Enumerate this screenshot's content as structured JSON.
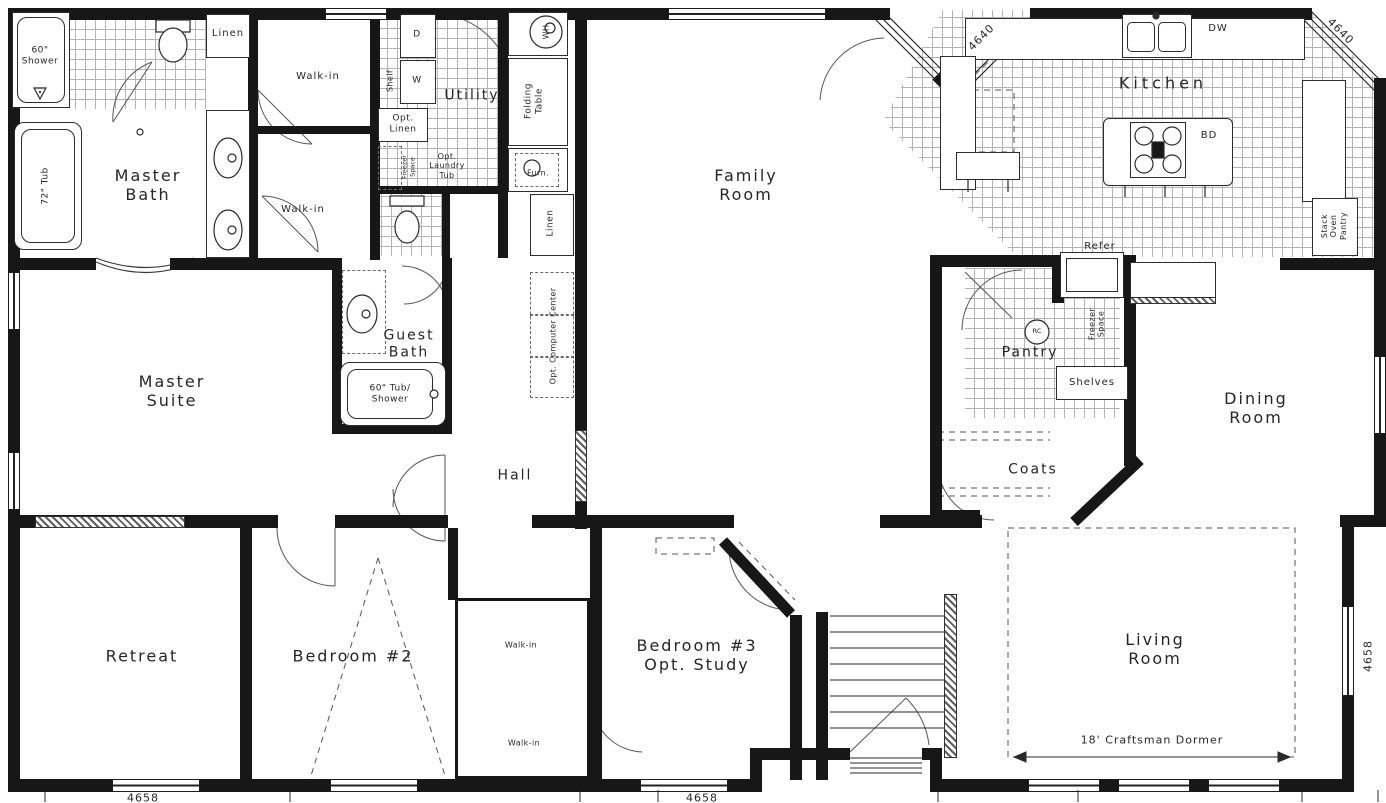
{
  "rooms": {
    "master_bath": "Master\nBath",
    "master_suite": "Master\nSuite",
    "guest_bath": "Guest\nBath",
    "utility": "Utility",
    "hall": "Hall",
    "family_room": "Family\nRoom",
    "kitchen": "Kitchen",
    "pantry": "Pantry",
    "dining_room": "Dining\nRoom",
    "coats": "Coats",
    "retreat": "Retreat",
    "bedroom_2": "Bedroom #2",
    "bedroom_3": "Bedroom #3\nOpt. Study",
    "living_room": "Living\nRoom"
  },
  "closets": {
    "linen_top": "Linen",
    "walkin_master_1": "Walk-in",
    "walkin_master_2": "Walk-in",
    "linen_hall": "Linen",
    "opt_linen": "Opt.\nLinen",
    "shelf": "Shelf",
    "folding_table": "Folding\nTable",
    "walkin_bed3_1": "Walk-in",
    "walkin_bed3_2": "Walk-in",
    "shelves": "Shelves",
    "stack_oven_pantry": "Stack\nOven\nPantry",
    "opt_computer_center": "Opt. Computer Center",
    "freezer_space_pantry": "Freezer\nSpace",
    "freezer_space_utility": "Freezer\nSpace"
  },
  "fixtures": {
    "shower_60": "60\"\nShower",
    "tub_72": "72\" Tub",
    "tub_shower_60": "60\" Tub/\nShower",
    "opt_laundry_tub": "Opt.\nLaundry\nTub",
    "dryer": "D",
    "washer": "W",
    "water_heater": "WH",
    "furnace": "Furn.",
    "dishwasher": "DW",
    "island_bd": "BD",
    "refrigerator": "Refer",
    "pantry_rc": "RC"
  },
  "annotations": {
    "craftsman_dormer": "18' Craftsman Dormer"
  },
  "dimensions": {
    "kitchen_left_4640": "4640",
    "kitchen_right_4640": "4640",
    "right_4658": "4658",
    "bottom_left_4658": "4658",
    "bottom_center_4658": "4658"
  }
}
